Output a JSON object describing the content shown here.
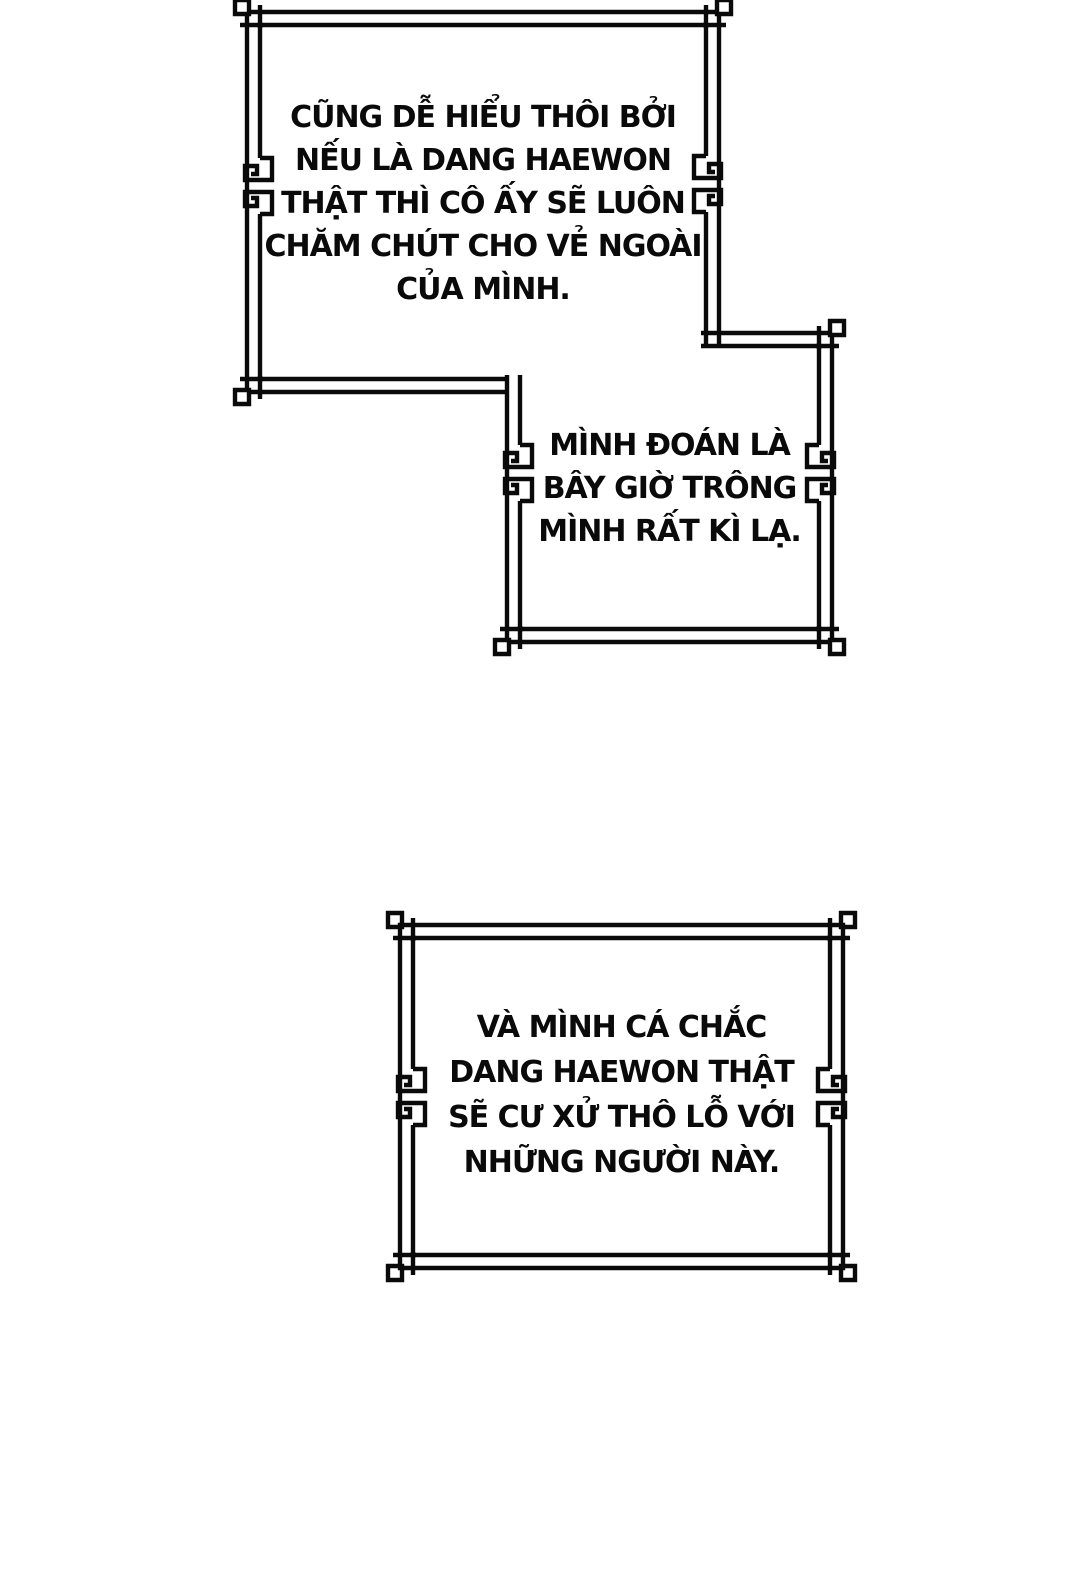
{
  "style": {
    "background": "#ffffff",
    "ink": "#0a0a0a"
  },
  "panels": [
    {
      "id": "panel-1",
      "lines": [
        "CŨNG DỄ HIỂU THÔI BỞI",
        "NẾU LÀ DANG HAEWON",
        "THẬT THÌ CÔ ẤY SẼ LUÔN",
        "CHĂM CHÚT CHO VẺ NGOÀI",
        "CỦA MÌNH."
      ]
    },
    {
      "id": "panel-2",
      "lines": [
        "MÌNH ĐOÁN LÀ",
        "BÂY GIỜ TRÔNG",
        "MÌNH RẤT KÌ LẠ."
      ]
    },
    {
      "id": "panel-3",
      "lines": [
        "VÀ MÌNH CÁ CHẮC",
        "DANG HAEWON THẬT",
        "SẼ CƯ XỬ THÔ LỖ VỚI",
        "NHỮNG NGƯỜI NÀY."
      ]
    }
  ]
}
